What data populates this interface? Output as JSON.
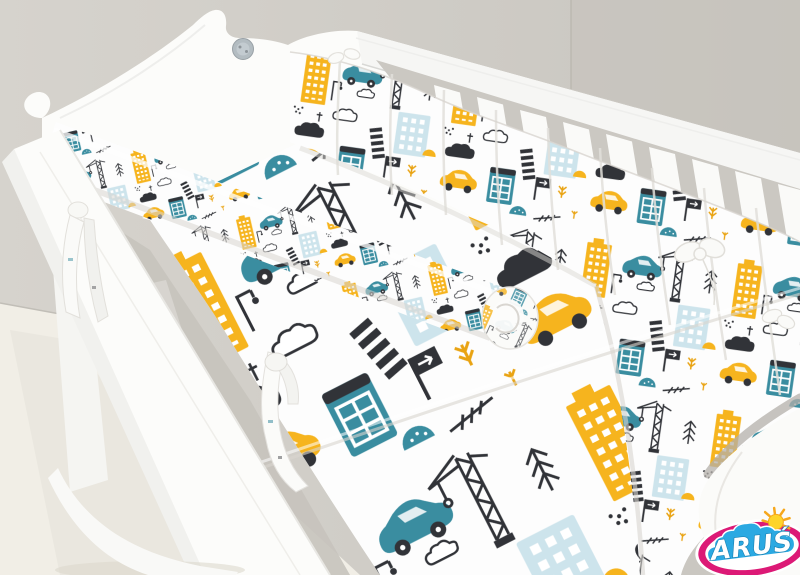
{
  "meta": {
    "description": "Product photo of a white wooden rocking crib dressed with a city-traffic and construction print bumper, bumper roll and bedding, photographed against a gray wall on a cream floor",
    "image_type": "product-photo"
  },
  "room": {
    "wall_color_left": "#d5d2cc",
    "wall_color_right": "#c7c3bd",
    "floor_color": "#f1eee6"
  },
  "crib": {
    "frame_color": "#fcfcfa",
    "style": "rocking cradle with scrolled decorative headboard",
    "button_color": "#b3bcc1",
    "visible_slat_count": 9
  },
  "bedding": {
    "base_color": "#fdfdfd",
    "pattern_theme": "city traffic and construction",
    "pieces": [
      "quilted bumper",
      "bumper roll pillow",
      "flat sheet",
      "duvet",
      "fabric ties"
    ],
    "motifs": [
      "yellow skyscraper",
      "teal car",
      "yellow car",
      "light-blue apartment building",
      "teal tram-window building",
      "construction crane",
      "dark cloud",
      "outlined cloud",
      "pine tree",
      "zebra crossing",
      "street sign",
      "street lamp",
      "fletched arrow",
      "yellow sprig",
      "teal dome",
      "yellow dome",
      "dot clusters"
    ],
    "palette": {
      "yellow": "#f6b41e",
      "teal": "#3a8da0",
      "light_blue": "#cde4ec",
      "dark": "#313338",
      "white": "#ffffff"
    }
  },
  "logo": {
    "text": "ARUŚ",
    "ring_color": "#dc1976",
    "cloud_color": "#2ba9e2",
    "sun_color": "#fed42a",
    "sun_ray_color": "#f6a71c",
    "text_color": "#ffffff",
    "text_outline_color": "#1a82b4"
  }
}
